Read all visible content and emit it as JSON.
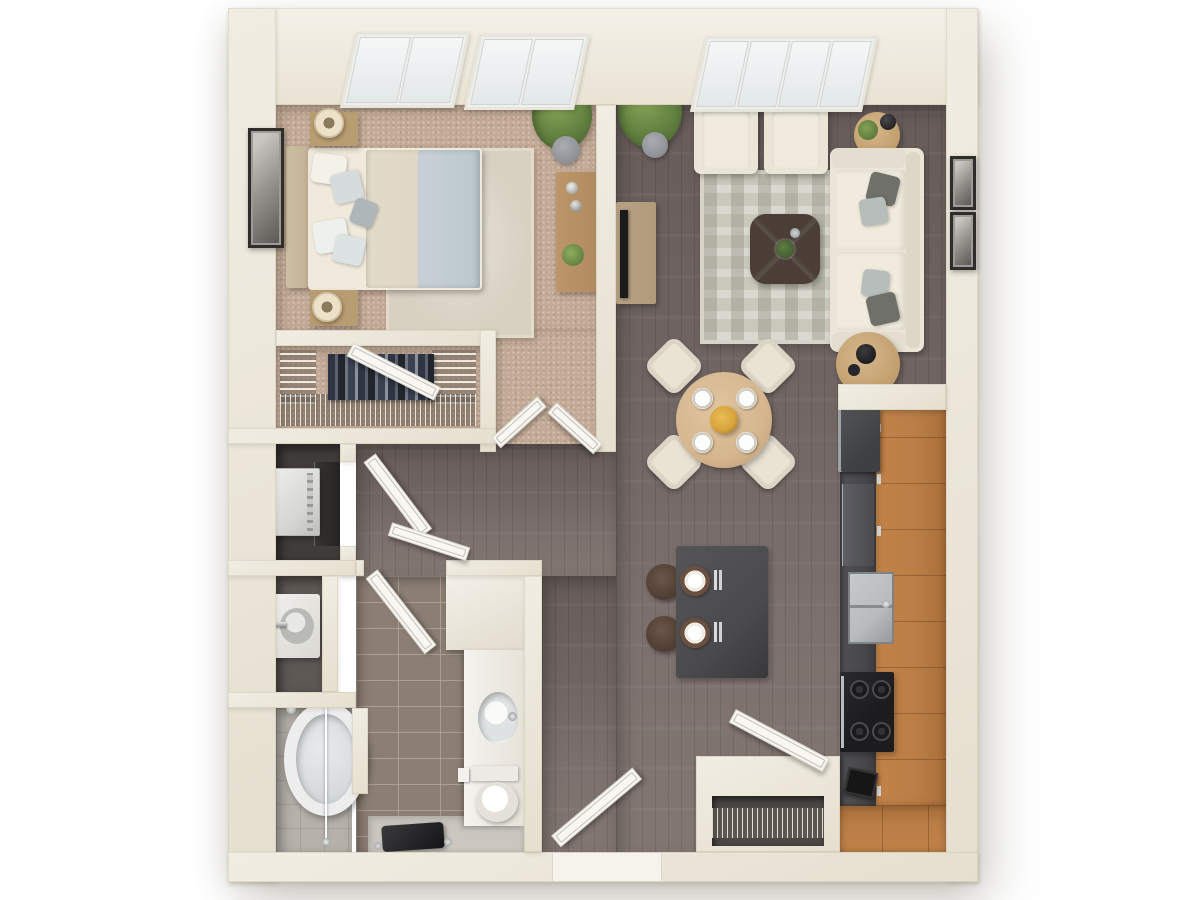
{
  "scene": {
    "kind": "3d-floor-plan-top-view",
    "description": "One-bedroom, one-bathroom apartment 3D floor plan render on white background",
    "background": "#ffffff"
  },
  "palette": {
    "wall": "#f1ede3",
    "wallShade": "#e5dfcf",
    "wallEdge": "#cfc7b4",
    "carpet": "#c3aa96",
    "bedRug": "#d8d0c1",
    "livingFloorA": "#675c5a",
    "livingFloorB": "#827772",
    "livingRug": "#cac8bb",
    "bathTile": "#8b7e74",
    "bathFloorLight": "#cbc7c0",
    "laundryFloor": "#403c3b",
    "sinkRoomFloor": "#5e5855",
    "showerFloor": "#b6b2ab",
    "cabinetWood": "#b97d46",
    "countertop": "#47474a",
    "applianceDark": "#3f4043",
    "stoveBlack": "#1c1c1e",
    "stainless": "#b9bcbe",
    "sofaCream": "#eae5d7",
    "cushion": "#f0ebdd",
    "pillowDark": "#70706a",
    "pillowLight": "#b7bdba",
    "diningWood": "#d5b68e",
    "chairCream": "#e9e3d4",
    "coffeeTable": "#4a3e37",
    "consoleWood": "#b09a7a",
    "dresserWood": "#b08b60",
    "nightstandWood": "#b99d72",
    "door": "#f8f7f3",
    "doorEdge": "#d8d4ca",
    "fixtureWhite": "#f4f3ef",
    "plantGreen": "#87a457",
    "plantDark": "#4c6631",
    "potGrey": "#8d9094",
    "frameDark": "#2e2d2c",
    "headboard": "#c3b296",
    "mattress": "#f0eadc",
    "duvet": "#e3dbc9",
    "blanket": "#c8d1d7",
    "island": "#4b4b4d",
    "stool": "#4e3c32",
    "tubWhite": "#ededee",
    "accentFlower": "#d9a43c"
  },
  "rooms": {
    "bedroom": {
      "label": "Bedroom",
      "floor": "carpet",
      "windows": 2
    },
    "livingRoom": {
      "label": "Living room",
      "floor": "hardwood",
      "windows": 1
    },
    "diningArea": {
      "label": "Dining area",
      "floor": "hardwood"
    },
    "kitchen": {
      "label": "Kitchen",
      "floor": "hardwood"
    },
    "walkInCloset": {
      "label": "Walk-in closet",
      "floor": "carpet"
    },
    "laundry": {
      "label": "Laundry closet",
      "floor": "vinyl"
    },
    "sinkRoom": {
      "label": "Vanity room",
      "floor": "vinyl"
    },
    "showerRoom": {
      "label": "Tub and shower room",
      "floor": "tile"
    },
    "bathroom": {
      "label": "Bathroom",
      "floor": "tile"
    },
    "hallway": {
      "label": "Hallway",
      "floor": "hardwood"
    },
    "entry": {
      "label": "Entry",
      "floor": "hardwood"
    }
  },
  "furniture": {
    "bedroom": [
      "queen bed",
      "upholstered headboard",
      "nightstand x2",
      "table lamp x2",
      "area rug",
      "dresser with decor",
      "framed wall art",
      "potted plant"
    ],
    "livingRoom": [
      "sofa with pillows",
      "armchair x2",
      "quatrefoil coffee table",
      "patterned area rug",
      "tv console",
      "flat tv",
      "round end table x2",
      "floor lamp",
      "framed picture x2",
      "potted plant"
    ],
    "diningArea": [
      "round dining table",
      "dining chair x4",
      "place setting x4",
      "flower centerpiece"
    ],
    "kitchen": [
      "refrigerator",
      "dishwasher",
      "stainless double sink",
      "range with 4 burners",
      "coffee maker",
      "bar island",
      "bar stool x2",
      "place setting x2",
      "wood cabinet run"
    ],
    "bathroom": [
      "vanity cabinet",
      "oval sink",
      "toilet",
      "toilet paper holder",
      "bench",
      "oval bathtub",
      "glass shower panel",
      "utility sink with faucet",
      "washer",
      "dryer"
    ],
    "walkInCloset": [
      "wire shelving x3",
      "hanging clothes"
    ],
    "entry": [
      "entry closet",
      "wire shelf"
    ]
  },
  "doors": [
    "bedroom double door",
    "walk-in closet door",
    "laundry door",
    "hallway door",
    "bathroom door",
    "front door",
    "entry closet door"
  ],
  "windows": {
    "bedroomCount": 2,
    "bedroomPanesEach": 2,
    "livingCount": 1,
    "livingPanes": 4
  }
}
